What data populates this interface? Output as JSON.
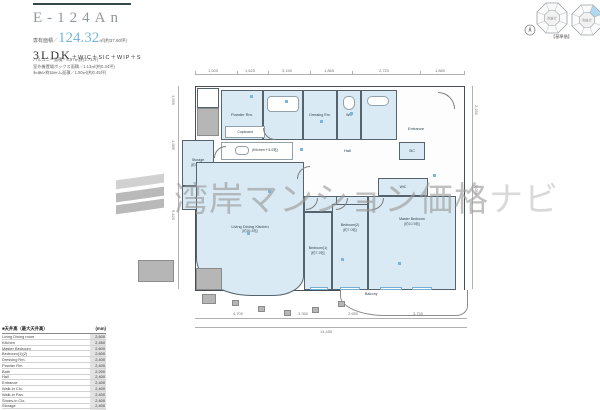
{
  "header": {
    "title": "E-124An",
    "area_prefix": "専有面積／",
    "area_value": "124.32",
    "area_suffix": "㎡(約37.60坪)",
    "layout": "3LDK",
    "layout_options": "＋WIC＋SIC＋WIP＋S",
    "sub_areas": [
      "バルコニー面積／8.97㎡(約2.71坪)",
      "室外機置場ボックス面積／1.13㎡(約0.34坪)",
      "トランクルーム面積／1.50㎡(約0.45坪)"
    ],
    "scale": "Scale=約1/80"
  },
  "location": {
    "caption": "【基準階】",
    "void_label": "吹抜け"
  },
  "watermark": {
    "text_main": "湾岸マンション価格",
    "text_sub": "ナビ"
  },
  "plan": {
    "rooms": {
      "ldk": {
        "name": "Living Dining Kitchen",
        "size": "(約26.4帖)"
      },
      "kitchen": {
        "name": "(Kitchen＋5.0帖)"
      },
      "cupboard": {
        "name": "Cupboard"
      },
      "master": {
        "name": "Master Bedroom",
        "size": "(約10.5帖)"
      },
      "bedroom1": {
        "name": "Bedroom(1)",
        "size": "(約7.2帖)"
      },
      "bedroom2": {
        "name": "Bedroom(2)",
        "size": "(約7.0帖)"
      },
      "powder": {
        "name": "Powder Rm."
      },
      "dressing": {
        "name": "Dressing Rm."
      },
      "wc": {
        "name": "WC"
      },
      "hall": {
        "name": "Hall"
      },
      "entrance": {
        "name": "Entrance"
      },
      "sic": {
        "name": "SIC"
      },
      "wic": {
        "name": "WIC"
      },
      "wip": {
        "name": "WIP"
      },
      "storage": {
        "name": "Storage",
        "size": "(約4.0帖)"
      },
      "balcony": {
        "name": "Balcony"
      }
    },
    "dims": {
      "top": [
        "1,500",
        "1,625",
        "3,150",
        "1,865",
        "2,720",
        "1,880"
      ],
      "bottom": [
        "4,700",
        "3,350",
        "2,650",
        "3,750"
      ],
      "bottom_total": "14,450",
      "left": [
        "1,595",
        "1,985",
        "5,420"
      ],
      "right": [
        "2,250",
        "9,050"
      ]
    }
  },
  "legend": {
    "header_left": "■天井高（最大天井高）",
    "header_right": "(mm)",
    "rows": [
      {
        "name": "Living Dining room",
        "value": "2,600"
      },
      {
        "name": "Kitchen",
        "value": "2,450"
      },
      {
        "name": "Master Bedroom",
        "value": "2,600"
      },
      {
        "name": "Bedroom(1)(2)",
        "value": "2,600"
      },
      {
        "name": "Dressing Rm.",
        "value": "2,400"
      },
      {
        "name": "Powder Rm.",
        "value": "2,400"
      },
      {
        "name": "Bath",
        "value": "2,200"
      },
      {
        "name": "Hall",
        "value": "2,400"
      },
      {
        "name": "Entrance",
        "value": "2,400"
      },
      {
        "name": "Walk-in Clo.",
        "value": "2,400"
      },
      {
        "name": "Walk-in Pan.",
        "value": "2,400"
      },
      {
        "name": "Shoes-in Clo.",
        "value": "2,400"
      },
      {
        "name": "Storage",
        "value": "2,400"
      },
      {
        "name": "WC",
        "value": "2,400"
      }
    ],
    "footnote": "※下り天井・梁下高は除きます。"
  }
}
